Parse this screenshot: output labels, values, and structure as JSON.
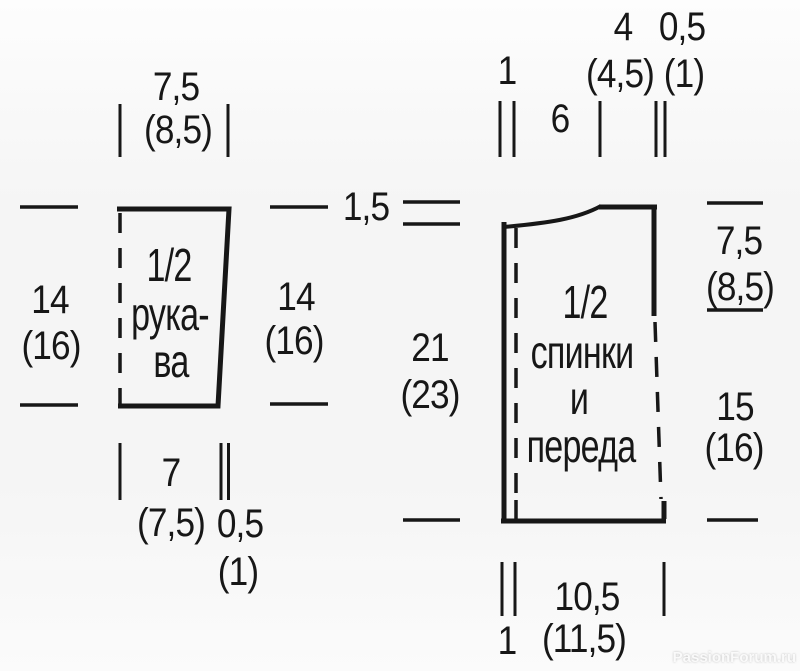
{
  "colors": {
    "line": "#171717",
    "text": "#171717",
    "background": "#f5f5f5",
    "watermark": "#fafafa"
  },
  "watermark_text": "PassionForum.ru",
  "sleeve": {
    "title": [
      "1/2",
      "рука-",
      "ва"
    ],
    "top_width": "7,5",
    "top_width_alt": "(8,5)",
    "left_height": "14",
    "left_height_alt": "(16)",
    "right_height": "14",
    "right_height_alt": "(16)",
    "bottom_width": "7",
    "bottom_width_alt": "(7,5)",
    "bottom_band": "0,5",
    "bottom_band_alt": "(1)"
  },
  "bodice": {
    "title": [
      "1/2",
      "спинки",
      "и",
      "переда"
    ],
    "band_top": "1",
    "neck_width": "6",
    "shoulder_width": "4",
    "shoulder_width_alt": "(4,5)",
    "shoulder_edge": "0,5",
    "shoulder_edge_alt": "(1)",
    "shoulder_drop": "1,5",
    "side_upper": "21",
    "side_upper_alt": "(23)",
    "armhole_depth": "7,5",
    "armhole_depth_alt": "(8,5)",
    "side_lower": "15",
    "side_lower_alt": "(16)",
    "bottom_width": "10,5",
    "bottom_width_alt": "(11,5)",
    "band_bottom": "1"
  }
}
